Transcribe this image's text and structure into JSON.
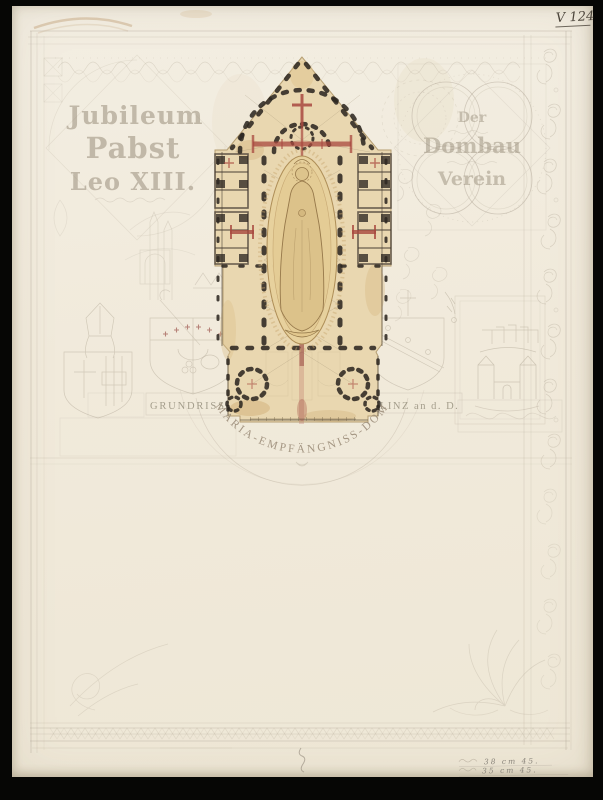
{
  "document": {
    "archive_mark": "V 124",
    "left_panel": {
      "line1": "Jubileum",
      "line2": "Pabst",
      "line3": "Leo XIII."
    },
    "right_panel": {
      "line1": "Der",
      "line2": "Dombau",
      "line3": "Verein"
    },
    "caption_band": {
      "left": "GRUNDRISS des",
      "right": "LINZ an d. D."
    },
    "arc_title": "MARIA-EMPFÄNGNISS-DOM",
    "margin_notes": {
      "line1": "38 cm 45.",
      "line2": "35 cm 45."
    }
  },
  "colors": {
    "scan_background": "#060605",
    "paper": "#f1ead9",
    "plan_paper": "#e9d7b0",
    "pencil": "#a79d8c",
    "plan_ink": "#2e2821",
    "accent_red": "#a8483f",
    "figure_wash": "#dcc28a"
  }
}
